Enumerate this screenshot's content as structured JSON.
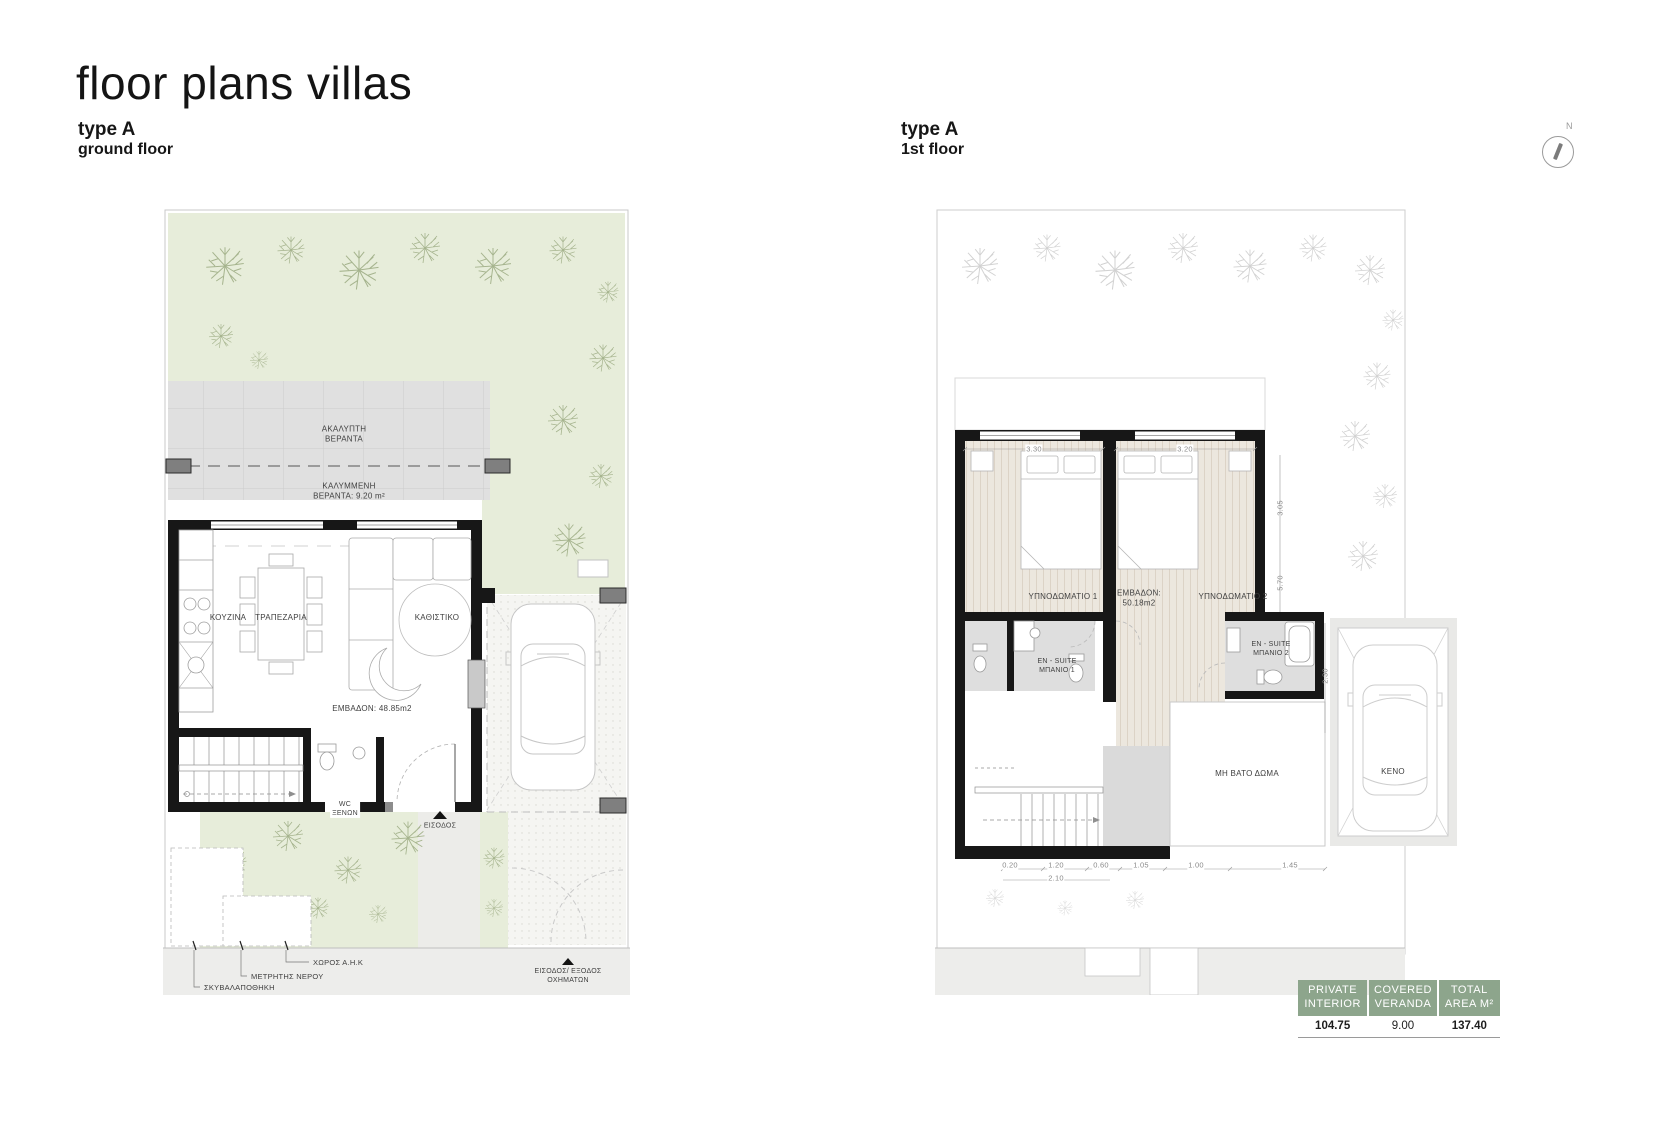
{
  "header": {
    "title": "floor plans villas",
    "left_type": "type A",
    "left_floor": "ground floor",
    "right_type": "type A",
    "right_floor": "1st floor",
    "compass_north": "N"
  },
  "ground_floor": {
    "veranda_open": {
      "l1": "ΑΚΑΛΥΠΤΗ",
      "l2": "ΒΕΡΑΝΤΑ"
    },
    "veranda_covered": {
      "l1": "ΚΑΛΥΜΜΕΝΗ",
      "l2": "ΒΕΡΑΝΤΑ: 9.20 m²"
    },
    "kitchen": "ΚΟΥΖΙΝΑ",
    "dining": "ΤΡΑΠΕΖΑΡΙΑ",
    "living": "ΚΑΘΙΣΤΙΚΟ",
    "area": "ΕΜΒΑΔΟΝ: 48.85m2",
    "wc": {
      "l1": "WC",
      "l2": "ΞΕΝΩΝ"
    },
    "entrance": "ΕΙΣΟΔΟΣ",
    "utility_ahk": "ΧΩΡΟΣ Α.Η.Κ",
    "water_meter": "ΜΕΤΡΗΤΗΣ ΝΕΡΟΥ",
    "garbage_store": "ΣΚΥΒΑΛΑΠΟΘΗΚΗ",
    "vehicle_access": {
      "l1": "ΕΙΣΟΔΟΣ/ ΕΞΟΔΟΣ",
      "l2": "ΟΧΗΜΑΤΩΝ"
    }
  },
  "first_floor": {
    "bedroom1": "ΥΠΝΟΔΩΜΑΤΙΟ 1",
    "bedroom2": "ΥΠΝΟΔΩΜΑΤΙΟ 2",
    "area": {
      "l1": "ΕΜΒΑΔΟΝ:",
      "l2": "50.18m2"
    },
    "ensuite1": {
      "l1": "EN - SUITE",
      "l2": "ΜΠΑΝΙΟ 1"
    },
    "ensuite2": {
      "l1": "EN - SUITE",
      "l2": "ΜΠΑΝΙΟ 2"
    },
    "roof": "ΜΗ ΒΑΤΟ ΔΩΜΑ",
    "void": "ΚΕΝΟ",
    "dims": {
      "top1": "3.30",
      "top2": "3.20",
      "right1": "3.05",
      "right2": "5.70",
      "right3": "2.30",
      "bottom": [
        "0.20",
        "1.20",
        "0.60",
        "1.05",
        "1.00",
        "1.45"
      ],
      "bottom_total": "2.10"
    }
  },
  "areas_table": {
    "columns": [
      {
        "header": [
          "PRIVATE",
          "INTERIOR"
        ],
        "value": "104.75"
      },
      {
        "header": [
          "COVERED",
          "VERANDA"
        ],
        "value": "9.00"
      },
      {
        "header": [
          "TOTAL",
          "AREA M²"
        ],
        "value": "137.40"
      }
    ],
    "header_bg": "#8da58c"
  },
  "colors": {
    "garden_green": "#e7edda",
    "veranda_grey": "#e0e0e0",
    "wall_black": "#171717",
    "table_header_green": "#8da58c"
  }
}
